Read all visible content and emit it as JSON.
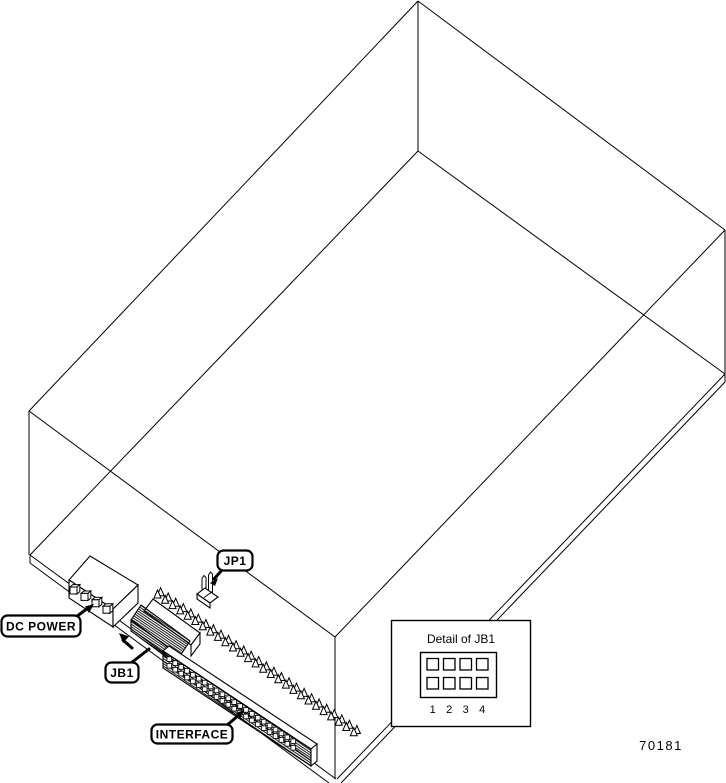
{
  "figure": {
    "colors": {
      "line": "#000000",
      "background": "#ffffff"
    },
    "callouts": {
      "dc_power": "DC POWER",
      "jb1": "JB1",
      "jp1": "JP1",
      "interface": "INTERFACE"
    },
    "detail_inset": {
      "title": "Detail of JB1",
      "columns": [
        "1",
        "2",
        "3",
        "4"
      ],
      "rows": 2
    },
    "interface_pin_count": 27,
    "dc_power_pin_count": 4,
    "part_number": "70181"
  }
}
